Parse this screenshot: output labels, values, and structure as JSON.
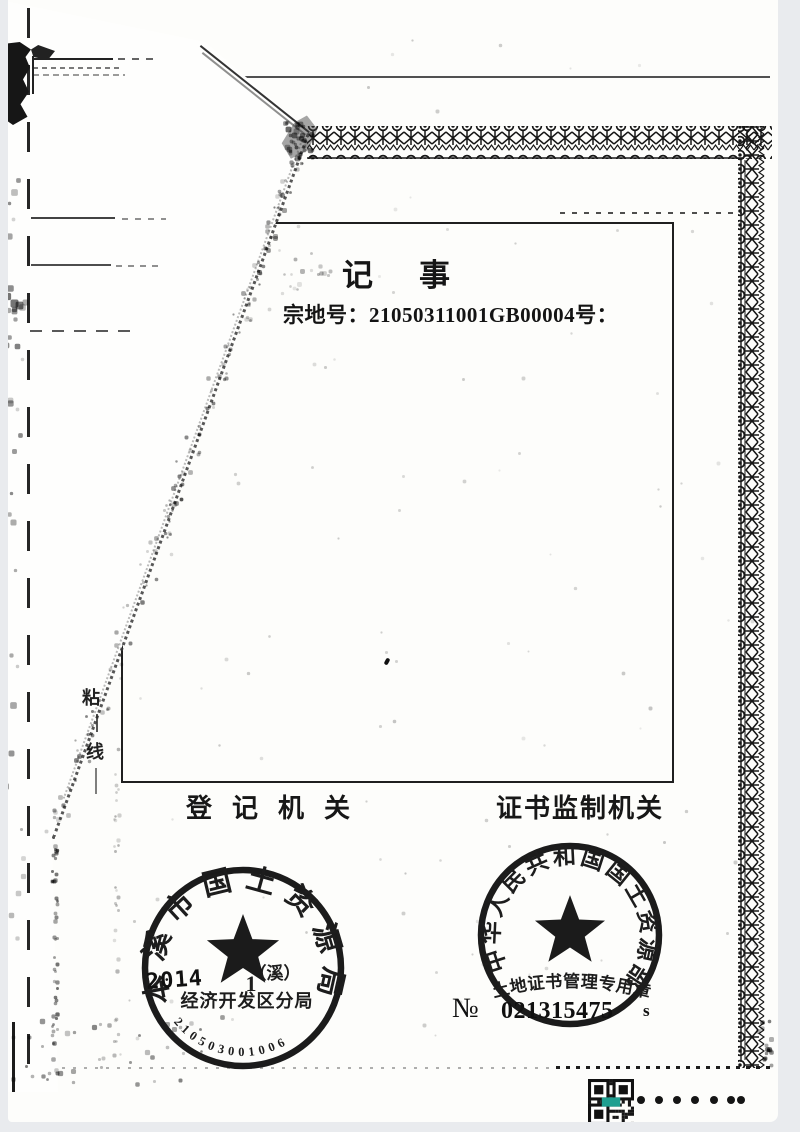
{
  "colors": {
    "ink": "#1c1c1c",
    "paper": "#fdfdfb",
    "scanner_bg": "#e9ebee",
    "qr_accent": "#1f9f90"
  },
  "note_box": {
    "title": "记事",
    "parcel_line": "宗地号：21050311001GB00004号："
  },
  "authority_row": {
    "registration_label": "登记机关",
    "supervision_label": "证书监制机关"
  },
  "paste_line": {
    "top_char": "粘",
    "bottom_char": "线"
  },
  "left_seal": {
    "ring_text": "本溪市国土资源局",
    "bracket_note": "（溪）",
    "date_digit": "1",
    "branch_line": "经济开发区分局",
    "serial_digits": "210503001006",
    "overlay_year": "2014"
  },
  "right_seal": {
    "ring_text": "中华人民共和国国土资源部",
    "banner_text": "土地证书管理专用章",
    "serial_prefix": "№",
    "serial_number": "021315475",
    "serial_suffix": "s"
  },
  "footer": {
    "dots": [
      "•",
      "•",
      "•",
      "•",
      "•",
      "•",
      "•"
    ]
  }
}
